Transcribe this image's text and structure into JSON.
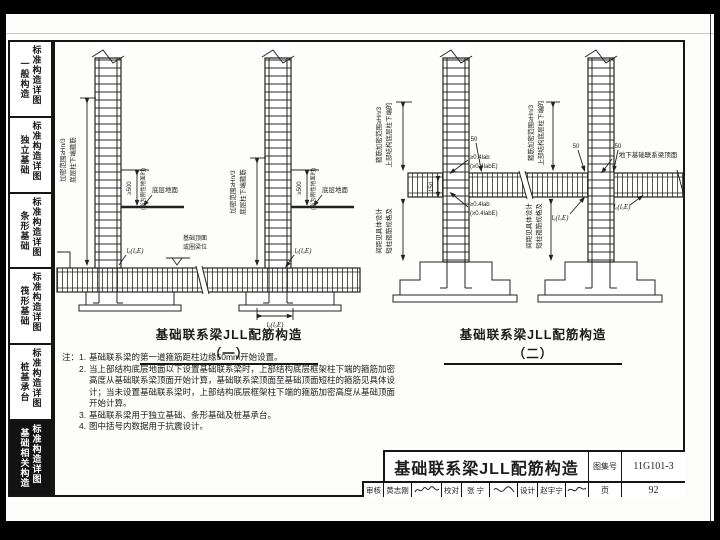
{
  "sidebar": {
    "items": [
      {
        "cat": "一般构造",
        "sub": "标准构造详图"
      },
      {
        "cat": "独立基础",
        "sub": "标准构造详图"
      },
      {
        "cat": "条形基础",
        "sub": "标准构造详图"
      },
      {
        "cat": "筏形基础",
        "sub": "标准构造详图"
      },
      {
        "cat": "桩基承台",
        "sub": "标准构造详图"
      },
      {
        "cat": "基础相关构造",
        "sub": "标准构造详图"
      }
    ]
  },
  "drawing1": {
    "title": "基础联系梁JLL配筋构造（一）",
    "labels": {
      "stirrup_note_l1": "底层柱下端箍筋",
      "stirrup_note_l2": "加密范围≥Hn/3",
      "dim_500": "≥500",
      "rigid_ground": "(当为刚性地面时)",
      "ground": "底层地面",
      "level_l1": "基础顶面",
      "level_l2": "或圈梁位",
      "anchor": "lₐ(lₐE)",
      "footing_dim": "lₐ(lₐE)"
    }
  },
  "drawing2": {
    "title": "基础联系梁JLL配筋构造（二）",
    "labels": {
      "upper_note_l1": "上部结构底层柱下端的",
      "upper_note_l2": "箍筋加密范围≥Hn/3",
      "short_col_note_l1": "短柱箍筋规格及",
      "short_col_note_l2": "间距见具体设计",
      "dim_50": "50",
      "anchor_straight": "≥0.4lab",
      "anchor_straight_e": "(≥0.4labE)",
      "dim_15d": "15d",
      "beam_top": "地下基础联系梁顶面",
      "anchor": "lₐ(lₐE)"
    }
  },
  "notes": {
    "prefix": "注：",
    "items": [
      {
        "no": "1.",
        "text": "基础联系梁的第一道箍筋距柱边缘50mm开始设置。"
      },
      {
        "no": "2.",
        "text": "当上部结构底层地面以下设置基础联系梁时，上部结构底层框架柱下端的箍筋加密高度从基础联系梁顶面开始计算，基础联系梁顶面至基础顶面短柱的箍筋见具体设计；当未设置基础联系梁时，上部结构底层框架柱下端的箍筋加密高度从基础顶面开始计算。"
      },
      {
        "no": "3.",
        "text": "基础联系梁用于独立基础、条形基础及桩基承台。"
      },
      {
        "no": "4.",
        "text": "图中括号内数据用于抗震设计。"
      }
    ]
  },
  "title_block": {
    "title": "基础联系梁JLL配筋构造",
    "atlas_label": "图集号",
    "atlas_no": "11G101-3",
    "page_label": "页",
    "page_no": "92",
    "reviewer_label": "审核",
    "reviewer": "黄志刚",
    "checker_label": "校对",
    "checker": "张 宁",
    "designer_label": "设计",
    "designer": "赵宇宁"
  }
}
